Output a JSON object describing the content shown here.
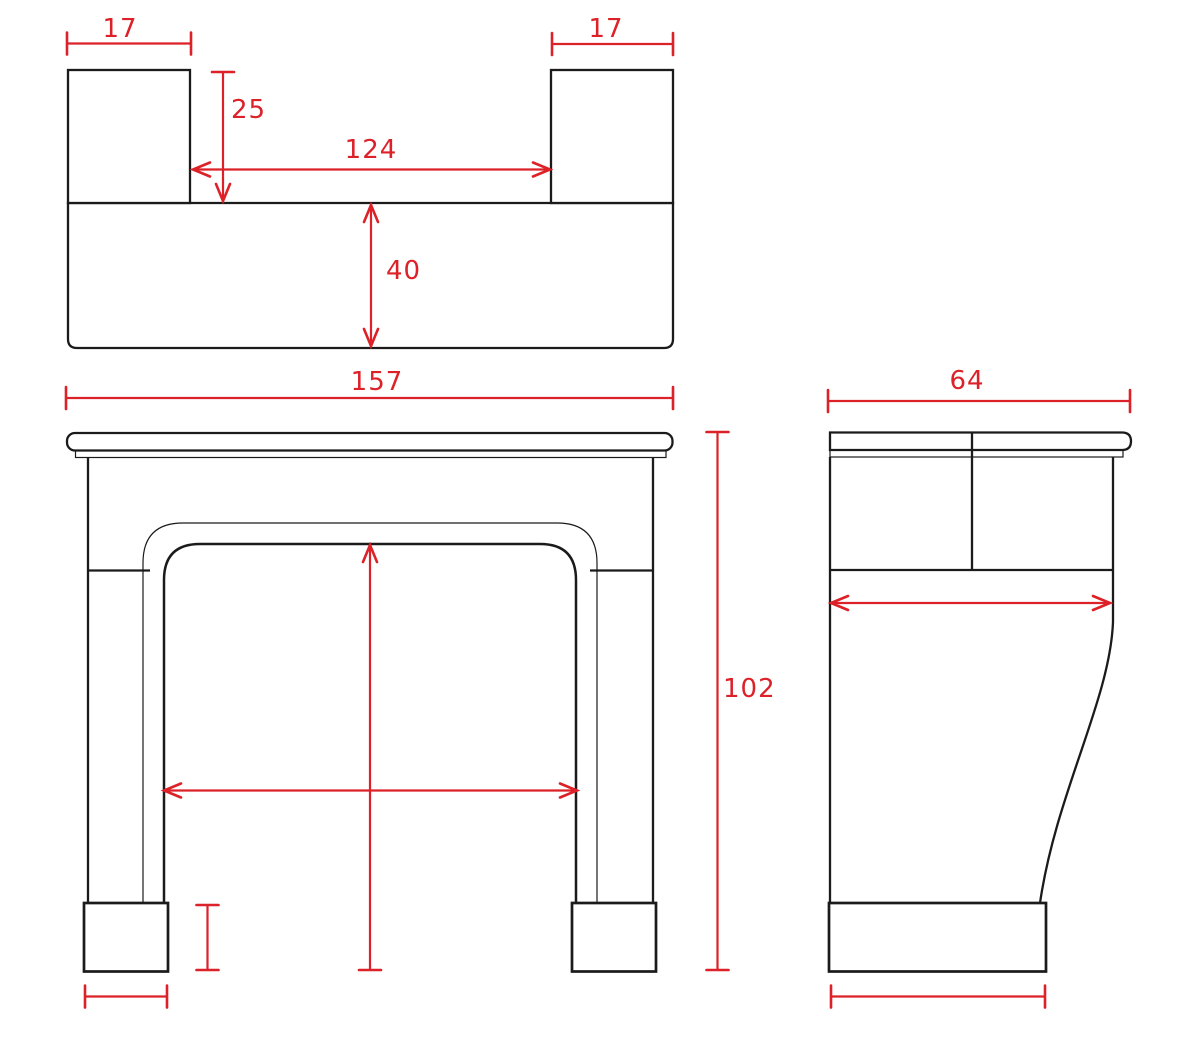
{
  "drawing": {
    "description": "fireplace mantel dimensioned technical drawing: plan view, front elevation, side elevation",
    "colors": {
      "paper": "#ffffff",
      "ink": "#1b1b1b",
      "dimension_red": "#dc2128"
    },
    "measurements": {
      "block_width": "17",
      "block_depth": "25",
      "between_blocks": "124",
      "shelf_depth_plan": "40",
      "overall_width": "157",
      "overall_height": "102",
      "overall_depth": "64"
    },
    "annotations": [
      {
        "id": "dim-top-left-block-width",
        "label": "17",
        "from": [
          67,
          43.5
        ],
        "to": [
          191,
          43.5
        ],
        "caps": [
          "tick",
          "tick"
        ],
        "label_pos": [
          120,
          37
        ],
        "anchor": "middle"
      },
      {
        "id": "dim-top-right-block-width",
        "label": "17",
        "from": [
          552,
          44
        ],
        "to": [
          673,
          44
        ],
        "caps": [
          "tick",
          "tick"
        ],
        "label_pos": [
          606,
          37
        ],
        "anchor": "middle"
      },
      {
        "id": "dim-top-block-depth",
        "label": "25",
        "from": [
          223,
          72
        ],
        "to": [
          223,
          201
        ],
        "caps": [
          "tick",
          "arrow"
        ],
        "label_pos": [
          231,
          118
        ],
        "anchor": "start"
      },
      {
        "id": "dim-top-between-blocks",
        "label": "124",
        "from": [
          193,
          169.5
        ],
        "to": [
          550,
          169.5
        ],
        "caps": [
          "arrow",
          "arrow"
        ],
        "label_pos": [
          371,
          158
        ],
        "anchor": "middle"
      },
      {
        "id": "dim-top-bar-depth",
        "label": "40",
        "from": [
          371,
          205
        ],
        "to": [
          371,
          346
        ],
        "caps": [
          "arrow",
          "arrow"
        ],
        "label_pos": [
          386,
          279
        ],
        "anchor": "start"
      },
      {
        "id": "dim-front-overall-width",
        "label": "157",
        "from": [
          66,
          398
        ],
        "to": [
          673,
          398
        ],
        "caps": [
          "tick",
          "tick"
        ],
        "label_pos": [
          377,
          390
        ],
        "anchor": "middle"
      },
      {
        "id": "dim-front-overall-height",
        "label": "102",
        "from": [
          717.5,
          432
        ],
        "to": [
          717.5,
          970
        ],
        "caps": [
          "tick",
          "tick"
        ],
        "label_pos": [
          723,
          697
        ],
        "anchor": "start"
      },
      {
        "id": "dim-side-overall-depth",
        "label": "64",
        "from": [
          828,
          401
        ],
        "to": [
          1130,
          401
        ],
        "caps": [
          "tick",
          "tick"
        ],
        "label_pos": [
          967,
          389
        ],
        "anchor": "middle"
      },
      {
        "id": "dim-front-opening-width",
        "label": "",
        "from": [
          164,
          790.5
        ],
        "to": [
          577,
          790.5
        ],
        "caps": [
          "arrow",
          "arrow"
        ],
        "label_pos": [
          370,
          780
        ],
        "anchor": "middle"
      },
      {
        "id": "dim-front-opening-height",
        "label": "",
        "from": [
          370,
          545
        ],
        "to": [
          370,
          970
        ],
        "caps": [
          "arrow",
          "tick"
        ],
        "label_pos": [
          380,
          760
        ],
        "anchor": "start"
      },
      {
        "id": "dim-front-foot-height",
        "label": "",
        "from": [
          207.5,
          905
        ],
        "to": [
          207.5,
          970
        ],
        "caps": [
          "tick",
          "tick"
        ],
        "label_pos": [
          220,
          940
        ],
        "anchor": "start"
      },
      {
        "id": "dim-front-foot-width",
        "label": "",
        "from": [
          85,
          996.5
        ],
        "to": [
          167,
          996.5
        ],
        "caps": [
          "tick",
          "tick"
        ],
        "label_pos": [
          126,
          1025
        ],
        "anchor": "middle"
      },
      {
        "id": "dim-side-shelf-projection",
        "label": "",
        "from": [
          831,
          603
        ],
        "to": [
          1110,
          603
        ],
        "caps": [
          "arrow",
          "arrow"
        ],
        "label_pos": [
          970,
          593
        ],
        "anchor": "middle"
      },
      {
        "id": "dim-side-foot-depth",
        "label": "",
        "from": [
          831,
          996.5
        ],
        "to": [
          1045,
          996.5
        ],
        "caps": [
          "tick",
          "tick"
        ],
        "label_pos": [
          938,
          1025
        ],
        "anchor": "middle"
      }
    ]
  }
}
